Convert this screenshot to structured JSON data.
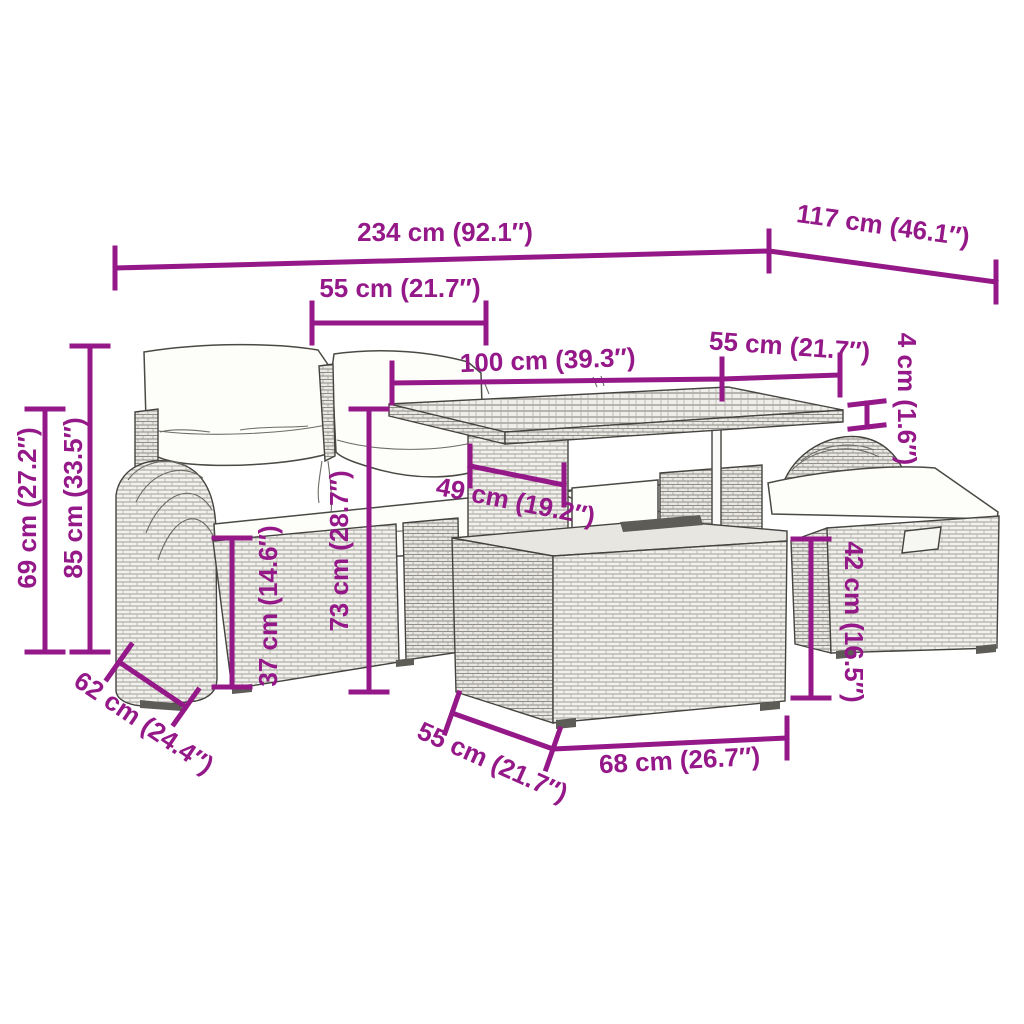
{
  "background_color": "#ffffff",
  "accent_color": "#951889",
  "artwork_line_color": "#44433f",
  "dims": {
    "d234": "234 cm (92.1″)",
    "d117": "117 cm (46.1″)",
    "d55_top": "55 cm (21.7″)",
    "d100": "100 cm (39.3″)",
    "d55_table": "55 cm (21.7″)",
    "d4": "4 cm (1.6″)",
    "d85": "85 cm (33.5″)",
    "d69": "69 cm (27.2″)",
    "d37": "37 cm (14.6″)",
    "d73": "73 cm (28.7″)",
    "d49": "49 cm (19.2″)",
    "d42": "42 cm (16.5″)",
    "d62": "62 cm (24.4″)",
    "d55_bottom": "55 cm (21.7″)",
    "d68": "68 cm (26.7″)"
  }
}
